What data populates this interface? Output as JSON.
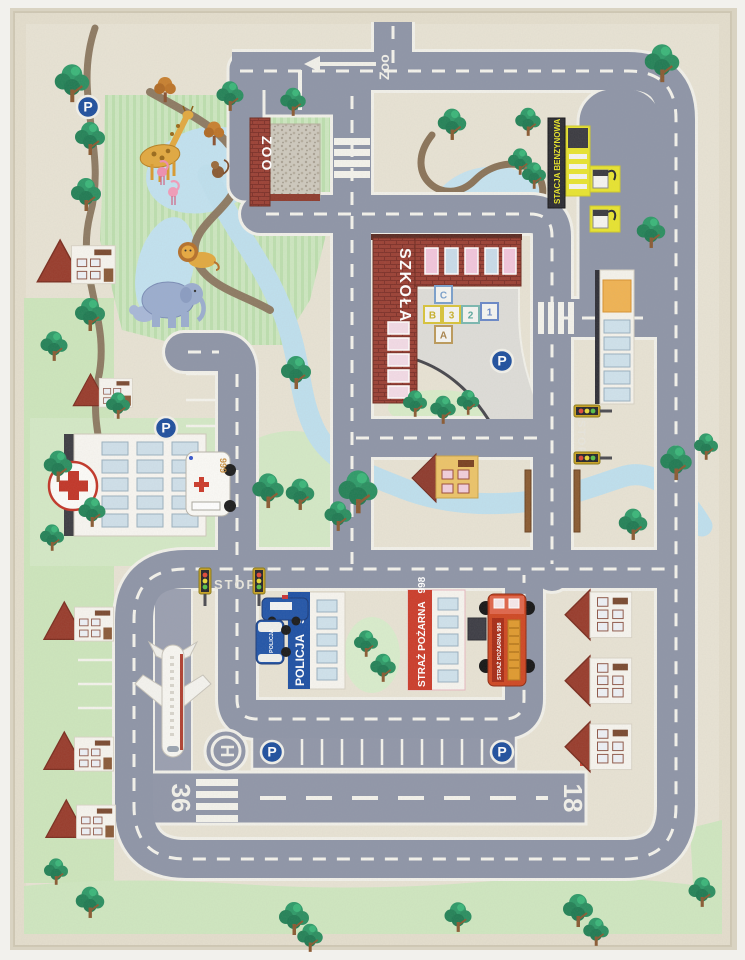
{
  "mat": {
    "markings": {
      "zoo_direction": "Zoo",
      "stop": "STOP",
      "runway_left": "36",
      "runway_right": "18",
      "helipad": "H",
      "parking": "P"
    },
    "zoo": {
      "gate": "ZOO"
    },
    "school": {
      "name": "SZKOŁA",
      "hopscotch": [
        "A",
        "B",
        "C",
        "1",
        "2",
        "3"
      ]
    },
    "gas_station": {
      "sign": "STACJA BENZYNOWA"
    },
    "police": {
      "name": "POLICJA",
      "number": "997",
      "car": "POLICJA"
    },
    "fire_station": {
      "name": "STRAŻ POŻARNA",
      "number": "998",
      "truck": "STRAŻ POŻARNA 998"
    },
    "hospital": {
      "ambulance": "999"
    },
    "colors": {
      "road": "#8e95a7",
      "road_marking": "#f4f3ec",
      "grass": "#cde7c0",
      "water": "#c2e2f0",
      "brick": "#9b4034",
      "police_blue": "#1d50a4",
      "fire_red": "#cc3c2a",
      "gas_yellow": "#e8e42f",
      "sign_blue": "#1e4f9e",
      "rug_base": "#e8e3d4"
    }
  }
}
